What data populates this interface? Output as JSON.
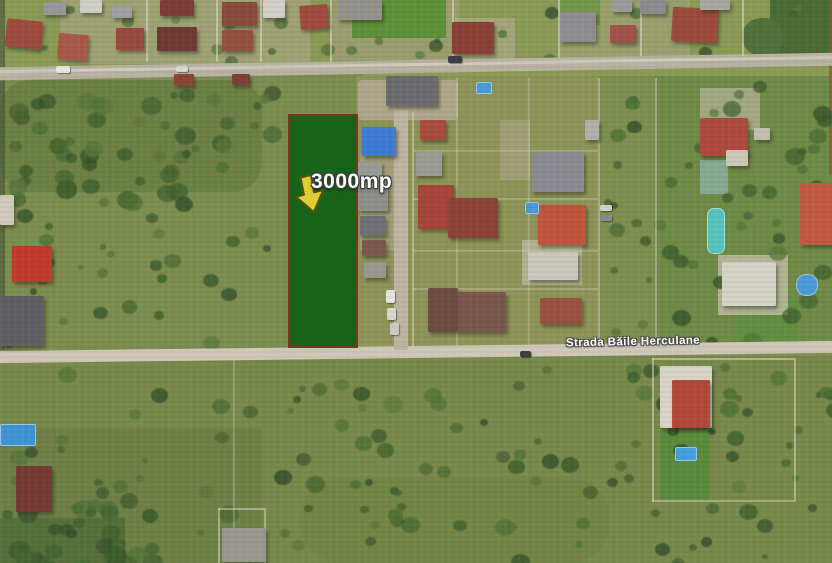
{
  "map": {
    "kind": "satellite-imagery",
    "width": 832,
    "height": 563
  },
  "annotations": {
    "parcel": {
      "label": "3000mp",
      "x": 288,
      "y": 114,
      "w": 70,
      "h": 234,
      "fill": "#176318",
      "border": "#7e3418"
    },
    "parcel_label_pos": {
      "x": 311,
      "y": 170
    },
    "arrow": {
      "x": 293,
      "y": 175,
      "w": 34,
      "h": 40,
      "rot": -14,
      "fill": "#ddcf33",
      "outline": "#55540f"
    },
    "street": {
      "label": "Strada Băile Herculane",
      "x": 548,
      "y": 336,
      "w": 170,
      "rot": -1.2
    }
  },
  "scene": {
    "fields": [
      {
        "x": 0,
        "y": 0,
        "w": 832,
        "h": 80,
        "c": "#8a9a55"
      },
      {
        "x": 60,
        "y": 0,
        "w": 250,
        "h": 64,
        "c": "#b3a98f",
        "o": 0.5
      },
      {
        "x": 330,
        "y": 0,
        "w": 130,
        "h": 60,
        "c": "#aea58c",
        "o": 0.45
      },
      {
        "x": 560,
        "y": 0,
        "w": 130,
        "h": 60,
        "c": "#b0a78e",
        "o": 0.4
      },
      {
        "x": 352,
        "y": 0,
        "w": 94,
        "h": 38,
        "c": "#5e9038"
      },
      {
        "x": 560,
        "y": 0,
        "w": 40,
        "h": 25,
        "c": "#679540",
        "o": 0.8
      },
      {
        "x": 770,
        "y": 0,
        "w": 62,
        "h": 58,
        "c": "#4a6b33"
      },
      {
        "x": 742,
        "y": 18,
        "w": 42,
        "h": 38,
        "c": "#52703a",
        "br": 40
      },
      {
        "x": 0,
        "y": 74,
        "w": 362,
        "h": 276,
        "c": "#7c8d4f"
      },
      {
        "x": 0,
        "y": 80,
        "w": 262,
        "h": 112,
        "c": "#65793f",
        "o": 0.65,
        "br": 30
      },
      {
        "x": 356,
        "y": 76,
        "w": 246,
        "h": 272,
        "c": "#8e9358"
      },
      {
        "x": 598,
        "y": 76,
        "w": 60,
        "h": 272,
        "c": "#7e8e50"
      },
      {
        "x": 655,
        "y": 76,
        "w": 177,
        "h": 272,
        "c": "#6f8a46"
      },
      {
        "x": 735,
        "y": 298,
        "w": 62,
        "h": 48,
        "c": "#5e8f3e",
        "o": 0.8
      },
      {
        "x": 0,
        "y": 356,
        "w": 832,
        "h": 207,
        "c": "#78894b"
      },
      {
        "x": 0,
        "y": 428,
        "w": 262,
        "h": 135,
        "c": "#6b7d43",
        "o": 0.75
      },
      {
        "x": 300,
        "y": 478,
        "w": 310,
        "h": 85,
        "c": "#70813f",
        "o": 0.55,
        "br": 40
      },
      {
        "x": 0,
        "y": 518,
        "w": 125,
        "h": 45,
        "c": "#55703a"
      },
      {
        "x": 660,
        "y": 394,
        "w": 50,
        "h": 106,
        "c": "#5b8a3c"
      },
      {
        "x": 0,
        "y": 0,
        "w": 5,
        "h": 350,
        "c": "#3c4a30",
        "o": 0.55
      },
      {
        "x": 829,
        "y": 0,
        "w": 3,
        "h": 175,
        "c": "#8a5a36",
        "o": 0.7
      }
    ],
    "bush_regions": [
      {
        "x": 0,
        "y": 84,
        "w": 285,
        "h": 118,
        "n": 55,
        "rmin": 4,
        "rmax": 11
      },
      {
        "x": 0,
        "y": 204,
        "w": 280,
        "h": 140,
        "n": 30,
        "rmin": 3,
        "rmax": 9
      },
      {
        "x": 598,
        "y": 84,
        "w": 58,
        "h": 258,
        "n": 16,
        "rmin": 3,
        "rmax": 8
      },
      {
        "x": 660,
        "y": 80,
        "w": 168,
        "h": 262,
        "n": 38,
        "rmin": 4,
        "rmax": 10
      },
      {
        "x": 0,
        "y": 362,
        "w": 832,
        "h": 196,
        "n": 120,
        "rmin": 3,
        "rmax": 10
      },
      {
        "x": 0,
        "y": 498,
        "w": 150,
        "h": 60,
        "n": 25,
        "rmin": 5,
        "rmax": 12
      },
      {
        "x": 0,
        "y": 0,
        "w": 832,
        "h": 58,
        "n": 24,
        "rmin": 3,
        "rmax": 7
      }
    ],
    "bush_colors": [
      "#42632f",
      "#3a5a2b",
      "#4d7034",
      "#55763a",
      "#35522a"
    ],
    "roads": [
      {
        "x": -8,
        "y": 60,
        "w": 848,
        "h": 13,
        "r": -1.0,
        "c": "#b9b2a3"
      },
      {
        "x": -8,
        "y": 63,
        "w": 848,
        "h": 3,
        "r": -1.0,
        "c": "#d6d0c2",
        "o": 0.8
      },
      {
        "x": -8,
        "y": 346,
        "w": 848,
        "h": 12,
        "r": -0.7,
        "c": "#cfc8b8"
      },
      {
        "x": 394,
        "y": 110,
        "w": 14,
        "h": 240,
        "c": "#bdb5a3"
      }
    ],
    "fences": [
      {
        "x": 146,
        "y": 0,
        "w": 1.5,
        "h": 62
      },
      {
        "x": 216,
        "y": 0,
        "w": 1.5,
        "h": 62
      },
      {
        "x": 260,
        "y": 0,
        "w": 1.5,
        "h": 62
      },
      {
        "x": 330,
        "y": 0,
        "w": 1.5,
        "h": 62
      },
      {
        "x": 452,
        "y": 0,
        "w": 1.5,
        "h": 58
      },
      {
        "x": 558,
        "y": 0,
        "w": 1.5,
        "h": 58
      },
      {
        "x": 640,
        "y": 0,
        "w": 1.5,
        "h": 56
      },
      {
        "x": 742,
        "y": 0,
        "w": 1.5,
        "h": 56
      },
      {
        "x": 412,
        "y": 112,
        "w": 1.5,
        "h": 234,
        "o": 0.5
      },
      {
        "x": 456,
        "y": 78,
        "w": 1.5,
        "h": 268,
        "o": 0.3
      },
      {
        "x": 528,
        "y": 78,
        "w": 1.5,
        "h": 268,
        "o": 0.3
      },
      {
        "x": 598,
        "y": 78,
        "w": 1.5,
        "h": 268,
        "o": 0.45
      },
      {
        "x": 655,
        "y": 78,
        "w": 1.5,
        "h": 268,
        "o": 0.45
      },
      {
        "x": 413,
        "y": 150,
        "w": 185,
        "h": 1.5,
        "o": 0.3
      },
      {
        "x": 413,
        "y": 198,
        "w": 185,
        "h": 1.5,
        "o": 0.3
      },
      {
        "x": 413,
        "y": 250,
        "w": 185,
        "h": 1.5,
        "o": 0.3
      },
      {
        "x": 413,
        "y": 288,
        "w": 185,
        "h": 1.5,
        "o": 0.3
      },
      {
        "x": 652,
        "y": 358,
        "w": 1.5,
        "h": 144,
        "o": 0.55
      },
      {
        "x": 794,
        "y": 358,
        "w": 1.5,
        "h": 144,
        "o": 0.55
      },
      {
        "x": 652,
        "y": 358,
        "w": 142,
        "h": 1.5,
        "o": 0.55
      },
      {
        "x": 652,
        "y": 500,
        "w": 142,
        "h": 1.5,
        "o": 0.45
      },
      {
        "x": 218,
        "y": 508,
        "w": 1.5,
        "h": 55,
        "o": 0.5
      },
      {
        "x": 264,
        "y": 508,
        "w": 1.5,
        "h": 55,
        "o": 0.5
      },
      {
        "x": 218,
        "y": 508,
        "w": 46,
        "h": 1.5,
        "o": 0.5
      },
      {
        "x": 233,
        "y": 360,
        "w": 1.5,
        "h": 200,
        "o": 0.3
      }
    ],
    "drives": [
      {
        "x": 358,
        "y": 80,
        "w": 100,
        "h": 40,
        "c": "#b6ac96",
        "o": 0.8,
        "br": 4
      },
      {
        "x": 360,
        "y": 155,
        "w": 38,
        "h": 95,
        "c": "#b2a890",
        "o": 0.55
      },
      {
        "x": 500,
        "y": 120,
        "w": 30,
        "h": 60,
        "c": "#b4ab94",
        "o": 0.5
      },
      {
        "x": 522,
        "y": 240,
        "w": 60,
        "h": 45,
        "c": "#c2bba8",
        "o": 0.7
      },
      {
        "x": 700,
        "y": 88,
        "w": 60,
        "h": 42,
        "c": "#c5bda9",
        "o": 0.6
      },
      {
        "x": 718,
        "y": 255,
        "w": 70,
        "h": 60,
        "c": "#cdc5b2",
        "o": 0.7
      },
      {
        "x": 455,
        "y": 18,
        "w": 60,
        "h": 42,
        "c": "#b8ae97",
        "o": 0.55
      },
      {
        "x": 700,
        "y": 160,
        "w": 28,
        "h": 34,
        "c": "#8fb3ac",
        "o": 0.75
      }
    ],
    "houses": [
      {
        "x": 6,
        "y": 20,
        "w": 36,
        "h": 28,
        "c": "#9e4a3e",
        "r": 6
      },
      {
        "x": 44,
        "y": 2,
        "w": 22,
        "h": 13,
        "c": "#98989a"
      },
      {
        "x": 58,
        "y": 34,
        "w": 30,
        "h": 26,
        "c": "#a85848",
        "r": 4
      },
      {
        "x": 80,
        "y": 0,
        "w": 22,
        "h": 13,
        "c": "#cfcfc9"
      },
      {
        "x": 112,
        "y": 6,
        "w": 20,
        "h": 12,
        "c": "#a0a0a2"
      },
      {
        "x": 116,
        "y": 28,
        "w": 28,
        "h": 22,
        "c": "#99493d"
      },
      {
        "x": 160,
        "y": 0,
        "w": 34,
        "h": 16,
        "c": "#7a3c34"
      },
      {
        "x": 157,
        "y": 27,
        "w": 40,
        "h": 24,
        "c": "#6e3a32"
      },
      {
        "x": 222,
        "y": 2,
        "w": 35,
        "h": 24,
        "c": "#8a4a3c"
      },
      {
        "x": 222,
        "y": 30,
        "w": 31,
        "h": 21,
        "c": "#94503e"
      },
      {
        "x": 263,
        "y": 0,
        "w": 22,
        "h": 18,
        "c": "#d2d0c8"
      },
      {
        "x": 300,
        "y": 5,
        "w": 28,
        "h": 24,
        "c": "#a04a40",
        "r": -4
      },
      {
        "x": 338,
        "y": 0,
        "w": 44,
        "h": 20,
        "c": "#93938c"
      },
      {
        "x": 452,
        "y": 22,
        "w": 42,
        "h": 32,
        "c": "#8a4034"
      },
      {
        "x": 560,
        "y": 12,
        "w": 36,
        "h": 30,
        "c": "#8e8d91"
      },
      {
        "x": 610,
        "y": 25,
        "w": 26,
        "h": 18,
        "c": "#a0524a"
      },
      {
        "x": 612,
        "y": 0,
        "w": 20,
        "h": 12,
        "c": "#9a9a96"
      },
      {
        "x": 672,
        "y": 8,
        "w": 46,
        "h": 34,
        "c": "#9c4a3c",
        "r": 3
      },
      {
        "x": 640,
        "y": 0,
        "w": 26,
        "h": 14,
        "c": "#8b8b8d"
      },
      {
        "x": 700,
        "y": 0,
        "w": 30,
        "h": 10,
        "c": "#a8a8a0"
      },
      {
        "x": 174,
        "y": 74,
        "w": 20,
        "h": 12,
        "c": "#8a4438"
      },
      {
        "x": 232,
        "y": 74,
        "w": 18,
        "h": 11,
        "c": "#7c4036"
      },
      {
        "x": 386,
        "y": 76,
        "w": 52,
        "h": 30,
        "c": "#6a6a70"
      },
      {
        "x": 362,
        "y": 127,
        "w": 34,
        "h": 29,
        "c": "#3d7cd2"
      },
      {
        "x": 420,
        "y": 120,
        "w": 26,
        "h": 20,
        "c": "#ab4a3e"
      },
      {
        "x": 416,
        "y": 152,
        "w": 26,
        "h": 24,
        "c": "#9b9b95"
      },
      {
        "x": 358,
        "y": 162,
        "w": 24,
        "h": 18,
        "c": "#9a9a94"
      },
      {
        "x": 358,
        "y": 185,
        "w": 30,
        "h": 26,
        "c": "#8f8f89"
      },
      {
        "x": 360,
        "y": 216,
        "w": 26,
        "h": 20,
        "c": "#6f6f75"
      },
      {
        "x": 362,
        "y": 240,
        "w": 24,
        "h": 16,
        "c": "#7c584c"
      },
      {
        "x": 364,
        "y": 262,
        "w": 22,
        "h": 16,
        "c": "#98988f"
      },
      {
        "x": 418,
        "y": 185,
        "w": 36,
        "h": 44,
        "c": "#a6453a"
      },
      {
        "x": 448,
        "y": 198,
        "w": 50,
        "h": 40,
        "c": "#8e4136"
      },
      {
        "x": 532,
        "y": 152,
        "w": 52,
        "h": 40,
        "c": "#8a8a90"
      },
      {
        "x": 585,
        "y": 120,
        "w": 14,
        "h": 20,
        "c": "#b0b0a8"
      },
      {
        "x": 538,
        "y": 205,
        "w": 48,
        "h": 40,
        "c": "#bf553c"
      },
      {
        "x": 528,
        "y": 252,
        "w": 50,
        "h": 28,
        "c": "#cbc8bd"
      },
      {
        "x": 428,
        "y": 288,
        "w": 30,
        "h": 44,
        "c": "#6e4c40"
      },
      {
        "x": 458,
        "y": 292,
        "w": 48,
        "h": 40,
        "c": "#7a564c"
      },
      {
        "x": 540,
        "y": 298,
        "w": 42,
        "h": 26,
        "c": "#9b5040"
      },
      {
        "x": 700,
        "y": 118,
        "w": 48,
        "h": 38,
        "c": "#ad493c"
      },
      {
        "x": 800,
        "y": 183,
        "w": 32,
        "h": 62,
        "c": "#c05a40"
      },
      {
        "x": 722,
        "y": 262,
        "w": 54,
        "h": 44,
        "c": "#d5d2c8"
      },
      {
        "x": 726,
        "y": 150,
        "w": 22,
        "h": 16,
        "c": "#cec8b8"
      },
      {
        "x": 754,
        "y": 128,
        "w": 16,
        "h": 12,
        "c": "#c4beac"
      },
      {
        "x": 0,
        "y": 195,
        "w": 14,
        "h": 30,
        "c": "#cfcabc"
      },
      {
        "x": 12,
        "y": 246,
        "w": 40,
        "h": 36,
        "c": "#c03a2c"
      },
      {
        "x": 0,
        "y": 296,
        "w": 44,
        "h": 50,
        "c": "#5f5f63"
      },
      {
        "x": 16,
        "y": 466,
        "w": 36,
        "h": 46,
        "c": "#753a32"
      },
      {
        "x": 222,
        "y": 528,
        "w": 44,
        "h": 34,
        "c": "#98988f"
      },
      {
        "x": 660,
        "y": 366,
        "w": 52,
        "h": 62,
        "c": "#d8d4c8"
      },
      {
        "x": 672,
        "y": 380,
        "w": 38,
        "h": 48,
        "c": "#b2483a"
      }
    ],
    "pools": [
      {
        "x": 476,
        "y": 82,
        "w": 14,
        "h": 10,
        "c": "#4a9ad8"
      },
      {
        "x": 525,
        "y": 202,
        "w": 12,
        "h": 10,
        "c": "#4a9ad8"
      },
      {
        "x": 707,
        "y": 208,
        "w": 16,
        "h": 44,
        "c": "#56c4bc",
        "br": 7
      },
      {
        "x": 796,
        "y": 274,
        "w": 20,
        "h": 20,
        "c": "#4a9ad8",
        "br": 10
      },
      {
        "x": 0,
        "y": 424,
        "w": 34,
        "h": 20,
        "c": "#3f93d4"
      },
      {
        "x": 675,
        "y": 447,
        "w": 20,
        "h": 12,
        "c": "#44a0dc"
      }
    ],
    "cars": [
      {
        "x": 56,
        "y": 66,
        "w": 14,
        "h": 7,
        "c": "#e8e8e6"
      },
      {
        "x": 176,
        "y": 66,
        "w": 12,
        "h": 6,
        "c": "#d8d8d4"
      },
      {
        "x": 448,
        "y": 56,
        "w": 14,
        "h": 7,
        "c": "#3c3c40"
      },
      {
        "x": 600,
        "y": 205,
        "w": 12,
        "h": 6,
        "c": "#d2d2ce"
      },
      {
        "x": 600,
        "y": 215,
        "w": 12,
        "h": 6,
        "c": "#8a8a88"
      },
      {
        "x": 386,
        "y": 290,
        "w": 9,
        "h": 13,
        "c": "#e4e4e0"
      },
      {
        "x": 387,
        "y": 308,
        "w": 9,
        "h": 12,
        "c": "#d8d8d2"
      },
      {
        "x": 390,
        "y": 323,
        "w": 9,
        "h": 12,
        "c": "#ccccc6"
      },
      {
        "x": 520,
        "y": 351,
        "w": 11,
        "h": 6,
        "c": "#3e3e42"
      }
    ]
  }
}
